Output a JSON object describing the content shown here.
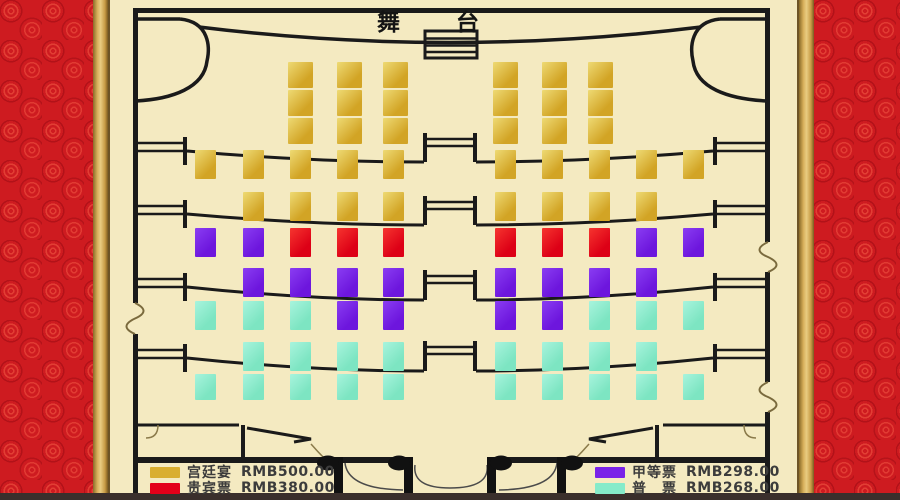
{
  "stage": {
    "label": "舞台"
  },
  "legend": {
    "items": [
      {
        "label": "宫廷宴",
        "price": "RMB500.00",
        "color": "#d9ae30"
      },
      {
        "label": "贵宾票",
        "price": "RMB380.00",
        "color": "#e30019"
      },
      {
        "label": "甲等票",
        "price": "RMB298.00",
        "color": "#7a22e8"
      },
      {
        "label": "普　票",
        "price": "RMB268.00",
        "color": "#85ebca"
      }
    ]
  },
  "colors": {
    "background": "#f4eac1",
    "border_red": "#ce1b20",
    "border_gold": "#d3a74e",
    "linework": "#1a1a1a",
    "bottom_strip": "#3a2f2c"
  },
  "seat_map": {
    "categories": {
      "gold": {
        "name": "宫廷宴",
        "price": "RMB500.00",
        "color": "#d2a425",
        "color2": "#eeda74"
      },
      "red": {
        "name": "贵宾票",
        "price": "RMB380.00",
        "color": "#dd0016",
        "color2": "#f6352f"
      },
      "purple": {
        "name": "甲等票",
        "price": "RMB298.00",
        "color": "#6d16dd",
        "color2": "#8a3df2"
      },
      "teal": {
        "name": "普票",
        "price": "RMB268.00",
        "color": "#7de5c2",
        "color2": "#a8f4dd"
      }
    },
    "rows": [
      {
        "y": 62,
        "h": 26,
        "w": 25,
        "seats": [
          [
            288,
            "gold"
          ],
          [
            337,
            "gold"
          ],
          [
            383,
            "gold"
          ],
          [
            493,
            "gold"
          ],
          [
            542,
            "gold"
          ],
          [
            588,
            "gold"
          ]
        ]
      },
      {
        "y": 90,
        "h": 26,
        "w": 25,
        "seats": [
          [
            288,
            "gold"
          ],
          [
            337,
            "gold"
          ],
          [
            383,
            "gold"
          ],
          [
            493,
            "gold"
          ],
          [
            542,
            "gold"
          ],
          [
            588,
            "gold"
          ]
        ]
      },
      {
        "y": 118,
        "h": 26,
        "w": 25,
        "seats": [
          [
            288,
            "gold"
          ],
          [
            337,
            "gold"
          ],
          [
            383,
            "gold"
          ],
          [
            493,
            "gold"
          ],
          [
            542,
            "gold"
          ],
          [
            588,
            "gold"
          ]
        ]
      },
      {
        "y": 150,
        "h": 29,
        "w": 21,
        "seats": [
          [
            195,
            "gold"
          ],
          [
            243,
            "gold"
          ],
          [
            290,
            "gold"
          ],
          [
            337,
            "gold"
          ],
          [
            383,
            "gold"
          ],
          [
            495,
            "gold"
          ],
          [
            542,
            "gold"
          ],
          [
            589,
            "gold"
          ],
          [
            636,
            "gold"
          ],
          [
            683,
            "gold"
          ]
        ]
      },
      {
        "y": 192,
        "h": 29,
        "w": 21,
        "seats": [
          [
            243,
            "gold"
          ],
          [
            290,
            "gold"
          ],
          [
            337,
            "gold"
          ],
          [
            383,
            "gold"
          ],
          [
            495,
            "gold"
          ],
          [
            542,
            "gold"
          ],
          [
            589,
            "gold"
          ],
          [
            636,
            "gold"
          ]
        ]
      },
      {
        "y": 228,
        "h": 29,
        "w": 21,
        "seats": [
          [
            195,
            "purple"
          ],
          [
            243,
            "purple"
          ],
          [
            290,
            "red"
          ],
          [
            337,
            "red"
          ],
          [
            383,
            "red"
          ],
          [
            495,
            "red"
          ],
          [
            542,
            "red"
          ],
          [
            589,
            "red"
          ],
          [
            636,
            "purple"
          ],
          [
            683,
            "purple"
          ]
        ]
      },
      {
        "y": 268,
        "h": 29,
        "w": 21,
        "seats": [
          [
            243,
            "purple"
          ],
          [
            290,
            "purple"
          ],
          [
            337,
            "purple"
          ],
          [
            383,
            "purple"
          ],
          [
            495,
            "purple"
          ],
          [
            542,
            "purple"
          ],
          [
            589,
            "purple"
          ],
          [
            636,
            "purple"
          ]
        ]
      },
      {
        "y": 301,
        "h": 29,
        "w": 21,
        "seats": [
          [
            195,
            "teal"
          ],
          [
            243,
            "teal"
          ],
          [
            290,
            "teal"
          ],
          [
            337,
            "purple"
          ],
          [
            383,
            "purple"
          ],
          [
            495,
            "purple"
          ],
          [
            542,
            "purple"
          ],
          [
            589,
            "teal"
          ],
          [
            636,
            "teal"
          ],
          [
            683,
            "teal"
          ]
        ]
      },
      {
        "y": 342,
        "h": 29,
        "w": 21,
        "seats": [
          [
            243,
            "teal"
          ],
          [
            290,
            "teal"
          ],
          [
            337,
            "teal"
          ],
          [
            383,
            "teal"
          ],
          [
            495,
            "teal"
          ],
          [
            542,
            "teal"
          ],
          [
            589,
            "teal"
          ],
          [
            636,
            "teal"
          ]
        ]
      },
      {
        "y": 374,
        "h": 26,
        "w": 21,
        "seats": [
          [
            195,
            "teal"
          ],
          [
            243,
            "teal"
          ],
          [
            290,
            "teal"
          ],
          [
            337,
            "teal"
          ],
          [
            383,
            "teal"
          ],
          [
            495,
            "teal"
          ],
          [
            542,
            "teal"
          ],
          [
            589,
            "teal"
          ],
          [
            636,
            "teal"
          ],
          [
            683,
            "teal"
          ]
        ]
      }
    ]
  }
}
